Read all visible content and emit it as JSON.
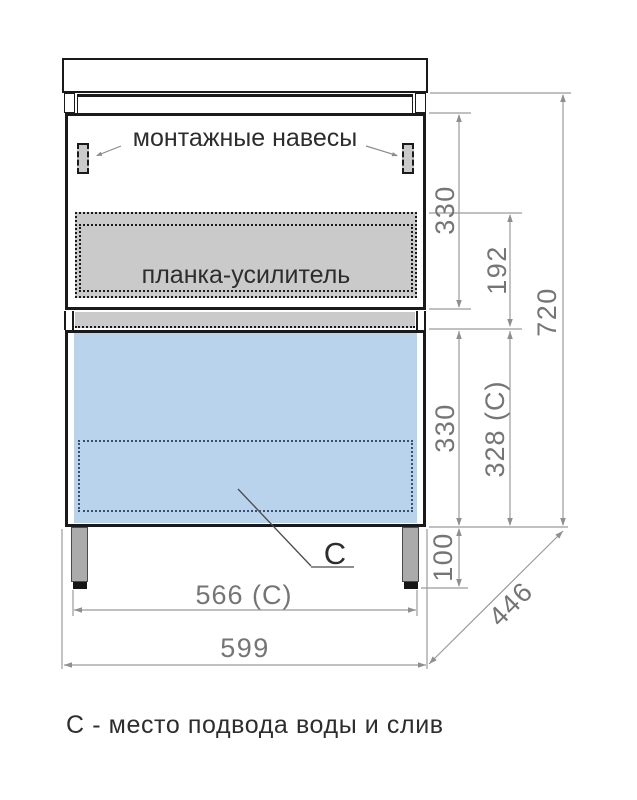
{
  "labels": {
    "mounting_brackets": "монтажные навесы",
    "reinforcement_plank": "планка-усилитель",
    "connection_marker": "С",
    "legend": "С - место подвода воды и слив"
  },
  "dimensions_mm": {
    "upper_section_height": "330",
    "plank_zone_height": "192",
    "overall_height": "720",
    "lower_section_height": "330",
    "lower_section_height_c": "328 (С)",
    "leg_height": "100",
    "connection_width_c": "566 (С)",
    "overall_width": "599",
    "depth": "446"
  },
  "colors": {
    "drawer_fill": "#b8d3eb",
    "plank_fill": "#cacaca",
    "outline": "#1a1a1a",
    "dimension_text": "#757575",
    "dimension_line": "#9b9b9b",
    "leg_fill": "#ababab"
  }
}
